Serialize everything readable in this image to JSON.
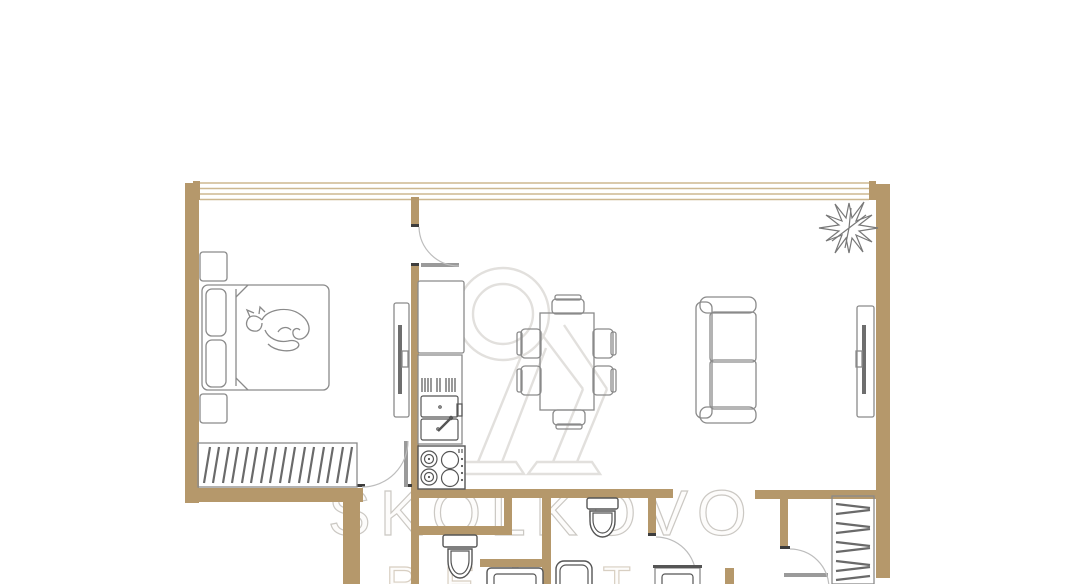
{
  "watermark": {
    "brand": "SKOLKOVO",
    "division": "REALTY"
  },
  "colors": {
    "background": "#ffffff",
    "wall": "#b5986b",
    "window_band": "#cdb890",
    "furniture_outline": "#8a8a8a",
    "fixture_outline": "#555555",
    "hanger": "#6a6a6a",
    "door_arc": "#bdbdbd",
    "door_leaf": "#9a9a9a",
    "jamb": "#3d3d3d",
    "watermark_text": "#cbc8c3",
    "watermark_sub_text": "#d8cfc2",
    "watermark_logo": "#e2e0dd"
  },
  "plan": {
    "type": "apartment-floor-plan",
    "furniture": [
      "double-bed-with-cat",
      "nightstand-top",
      "nightstand-bottom",
      "bedroom-wardrobe-hangers",
      "bedroom-tv-console",
      "refrigerator",
      "kitchen-counter-with-double-sink",
      "cooktop-4-burners",
      "dining-table-6-chairs",
      "sofa",
      "living-room-tv-console",
      "potted-plant",
      "toilet-bathroom-1",
      "toilet-bathroom-2",
      "washing-machine",
      "shower-tray",
      "bathroom-vanity-sink",
      "hall-closet-hangers"
    ]
  }
}
